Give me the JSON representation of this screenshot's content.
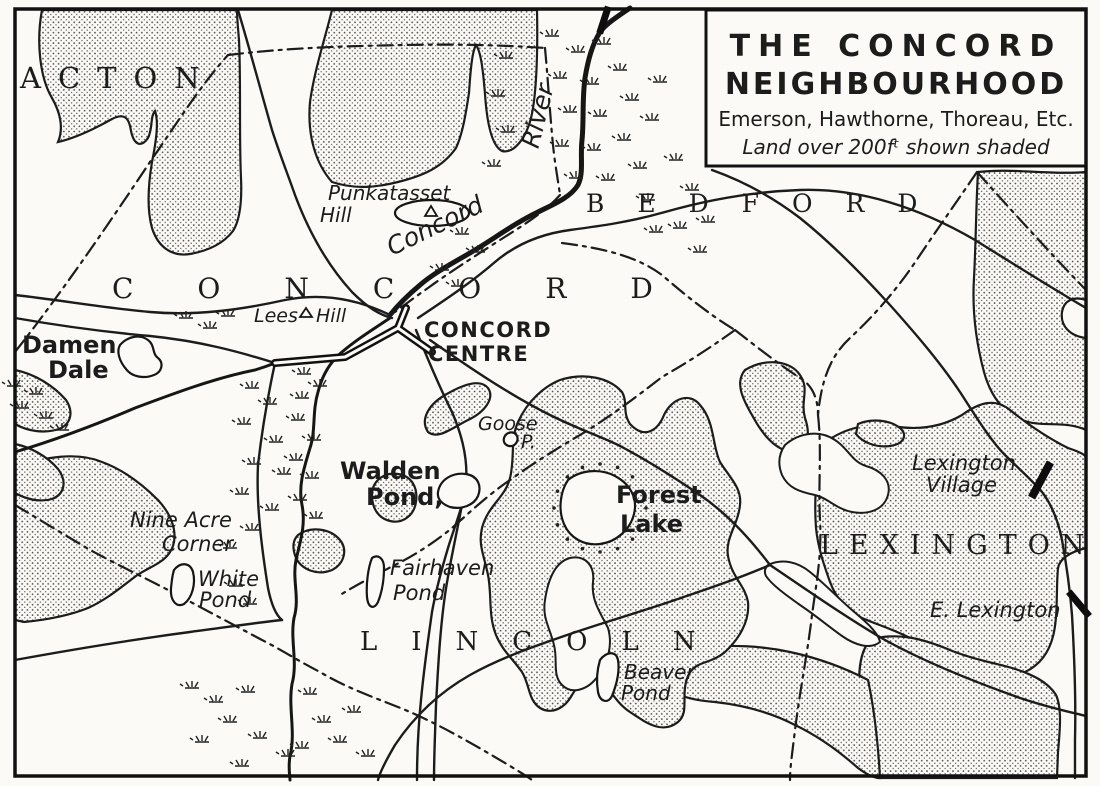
{
  "colors": {
    "ink": "#1c1c1c",
    "paper": "#fbfaf6",
    "stipple_dot": "#4a4a4a"
  },
  "title_box": {
    "line1": "THE CONCORD",
    "line2": "NEIGHBOURHOOD",
    "subtitle": "Emerson, Hawthorne, Thoreau, Etc.",
    "legend": "Land over 200fᵗ shown shaded"
  },
  "towns": {
    "acton": "ACTON",
    "concord": "CONCORD",
    "bedford": "BEDFORD",
    "lexington": "LEXINGTON",
    "lincoln": "LINCOLN"
  },
  "rivers": {
    "concord_name": "Concord",
    "concord_word": "River"
  },
  "places": {
    "punkatasset_line1": "Punkatasset",
    "punkatasset_line2": "Hill",
    "lees": "Lees",
    "lees_hill": "Hill",
    "centre_line1": "CONCORD",
    "centre_line2": "CENTRE",
    "damen_line1": "Damen",
    "damen_line2": "Dale",
    "goose_line1": "Goose",
    "goose_line2": "P.",
    "walden_line1": "Walden",
    "walden_line2": "Pond,",
    "forest_line1": "Forest",
    "forest_line2": "Lake",
    "nineacre_line1": "Nine Acre",
    "nineacre_line2": "Corner",
    "white_line1": "White",
    "white_line2": "Pond",
    "fairhaven_line1": "Fairhaven",
    "fairhaven_line2": "Pond",
    "beaver_line1": "Beaver",
    "beaver_line2": "Pond",
    "lexvillage_line1": "Lexington",
    "lexvillage_line2": "Village",
    "elexington": "E. Lexington"
  },
  "symbols": {
    "marsh": "marsh-tuft-icon",
    "hill": "hill-triangle-icon",
    "village_marker": "village-bar-icon",
    "shading": "stipple-dots"
  }
}
